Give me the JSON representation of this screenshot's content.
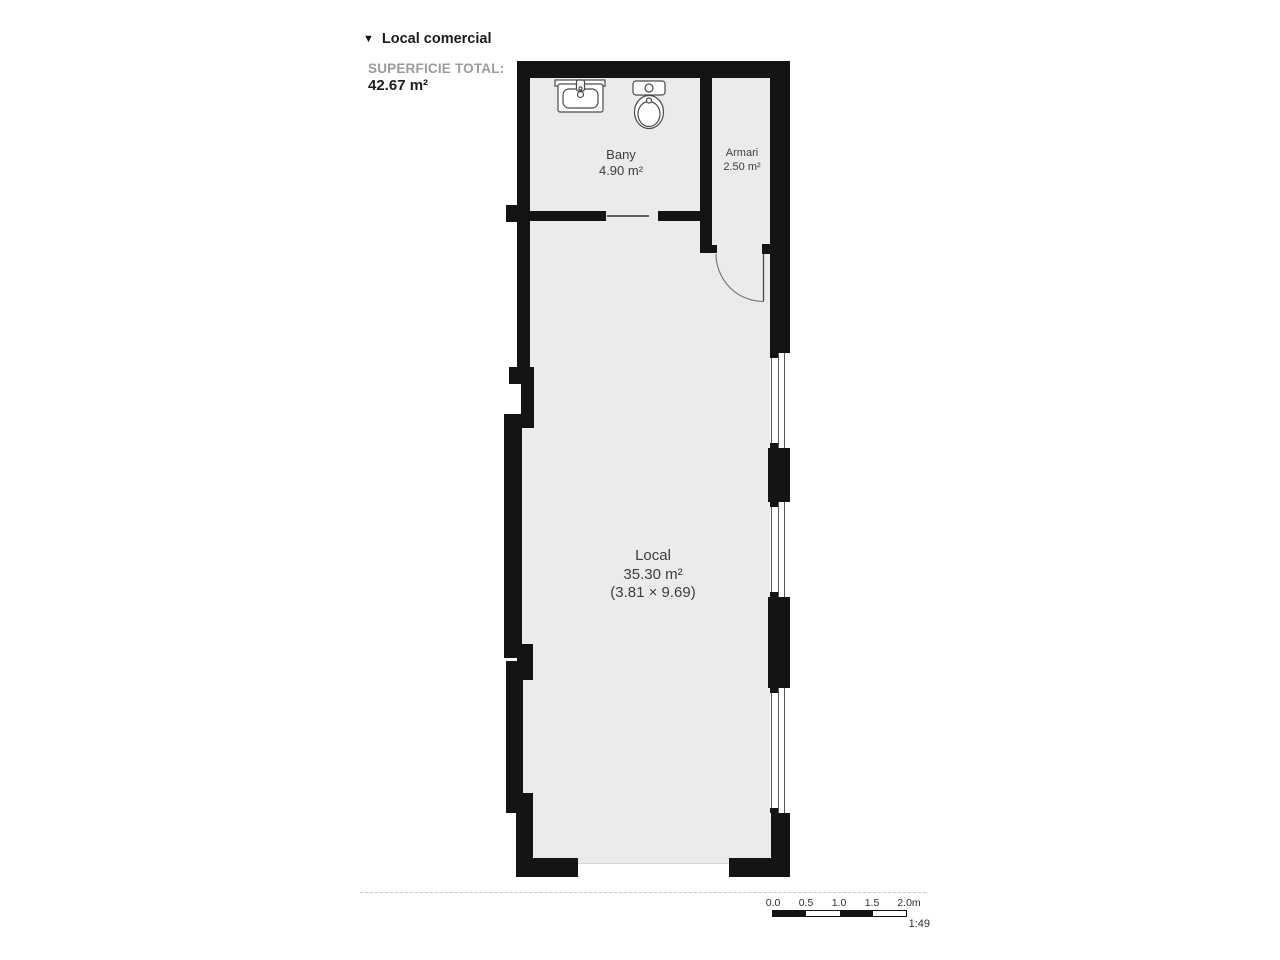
{
  "header": {
    "collapse_marker": "▼",
    "title": "Local comercial"
  },
  "summary": {
    "label": "SUPERFICIE TOTAL:",
    "value": "42.67 m²"
  },
  "rooms": {
    "bany": {
      "name": "Bany",
      "area": "4.90 m²"
    },
    "armari": {
      "name": "Armari",
      "area": "2.50 m²"
    },
    "local": {
      "name": "Local",
      "area": "35.30 m²",
      "dimensions": "(3.81 × 9.69)"
    }
  },
  "fixtures": {
    "sink": "sink-top-view",
    "toilet": "toilet-top-view"
  },
  "scale_bar": {
    "ticks": [
      "0.0",
      "0.5",
      "1.0",
      "1.5",
      "2.0m"
    ],
    "ratio": "1:49"
  },
  "colors": {
    "wall": "#141414",
    "floor": "#ebebeb",
    "muted_label": "#9b9b9b",
    "room_text": "#3d3d3d"
  }
}
